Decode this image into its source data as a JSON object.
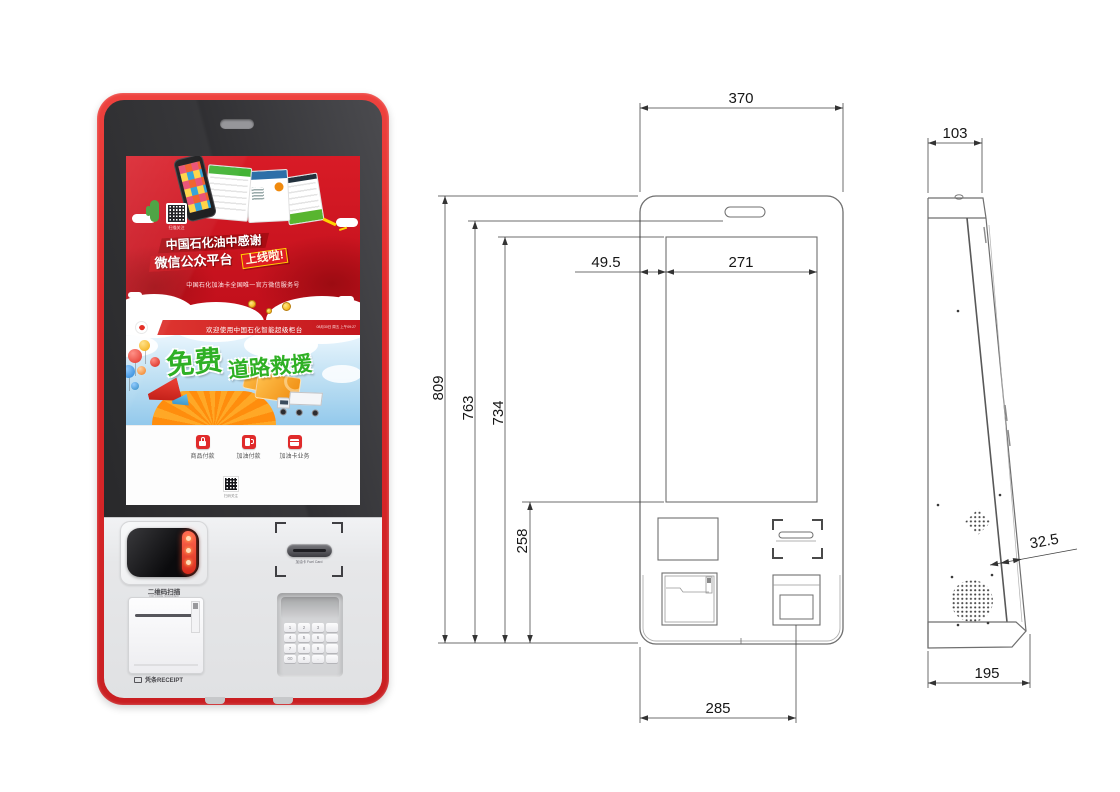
{
  "colors": {
    "kiosk_red": "#e02a2c",
    "ad_red": "#c00f1b",
    "promo_green": "#2fb025",
    "button_red": "#e02b2b",
    "drawing_line": "#6f6f6f"
  },
  "kiosk": {
    "ad": {
      "line1": "中国石化油中感谢",
      "line2": "微信公众平台",
      "badge": "上线啦!",
      "subline": "中国石化加油卡全国唯一官方微信服务号",
      "qr_caption": "扫描关注"
    },
    "screen": {
      "header": "欢迎使用中国石化智能超级柜台",
      "header_right": "08月30日 周五 上午09:27",
      "promo1": "免费",
      "promo2": "道路救援",
      "buttons": [
        {
          "label": "商品付款",
          "icon": "bag-icon"
        },
        {
          "label": "加油付款",
          "icon": "pump-icon"
        },
        {
          "label": "加油卡业务",
          "icon": "card-icon"
        }
      ],
      "qr_caption": "扫码关注"
    },
    "hardware": {
      "scanner_label": "二维码扫描",
      "scanner_sublabel": "QR CODE SCANNER",
      "receipt_label": "凭条RECEIPT",
      "card_label": "加油卡 Fuel Card",
      "keypad_keys": [
        "1",
        "2",
        "3",
        "",
        "4",
        "5",
        "6",
        "",
        "7",
        "8",
        "9",
        "",
        "00",
        "0",
        ".",
        ""
      ]
    }
  },
  "front_view": {
    "dims": {
      "top_width": "370",
      "screen_offset": "49.5",
      "screen_width": "271",
      "total_height": "809",
      "slot_height": "763",
      "screen_height": "734",
      "lower_height": "258",
      "bottom_width": "285"
    }
  },
  "side_view": {
    "dims": {
      "top_depth": "103",
      "panel_thickness": "32.5",
      "bottom_depth": "195"
    }
  }
}
